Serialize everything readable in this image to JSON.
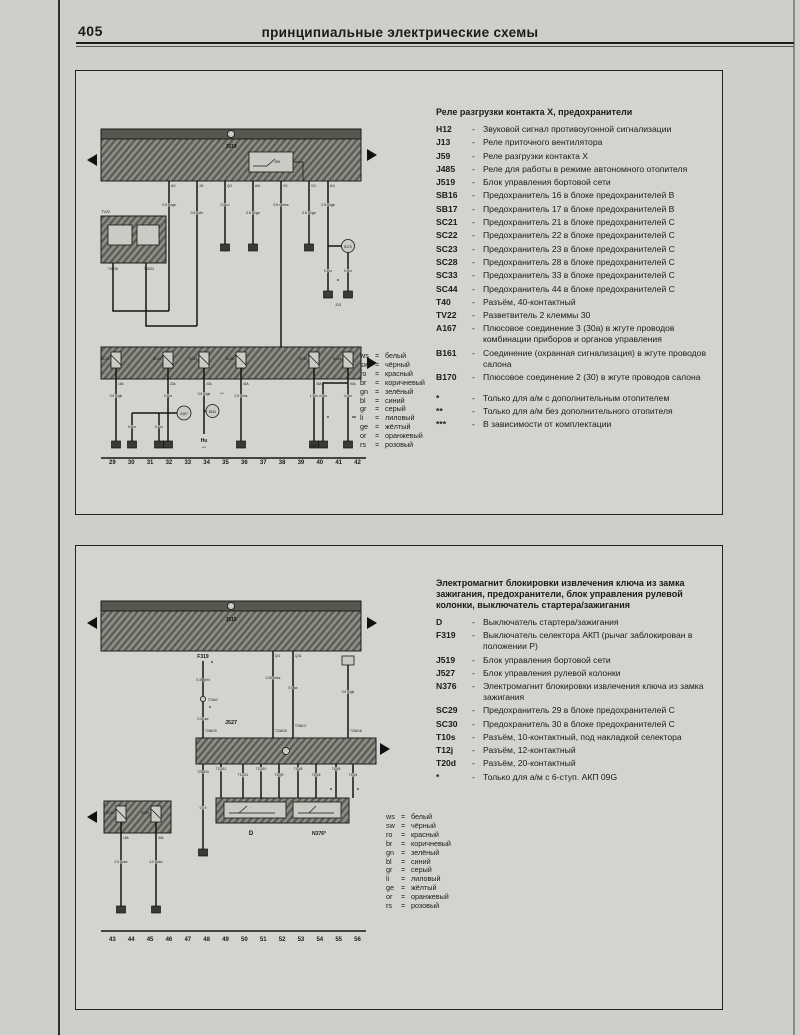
{
  "page": {
    "number": "405",
    "title": "принципиальные электрические схемы"
  },
  "wire_color_legend": [
    {
      "code": "ws",
      "name": "белый"
    },
    {
      "code": "sw",
      "name": "чёрный"
    },
    {
      "code": "ro",
      "name": "красный"
    },
    {
      "code": "br",
      "name": "коричневый"
    },
    {
      "code": "gn",
      "name": "зелёный"
    },
    {
      "code": "bl",
      "name": "синий"
    },
    {
      "code": "gr",
      "name": "серый"
    },
    {
      "code": "li",
      "name": "лиловый"
    },
    {
      "code": "ge",
      "name": "жёлтый"
    },
    {
      "code": "or",
      "name": "оранжевый"
    },
    {
      "code": "rs",
      "name": "розовый"
    }
  ],
  "d1": {
    "legend_title": "Реле разгрузки контакта X, предохранители",
    "legend": [
      {
        "term": "H12",
        "desc": "Звуковой сигнал противоугонной сигнализации"
      },
      {
        "term": "J13",
        "desc": "Реле приточного вентилятора"
      },
      {
        "term": "J59",
        "desc": "Реле разгрузки контакта X"
      },
      {
        "term": "J485",
        "desc": "Реле для работы в режиме автономного отопителя"
      },
      {
        "term": "J519",
        "desc": "Блок управления бортовой сети"
      },
      {
        "term": "SB16",
        "desc": "Предохранитель 16 в блоке предохранителей B"
      },
      {
        "term": "SB17",
        "desc": "Предохранитель 17 в блоке предохранителей B"
      },
      {
        "term": "SC21",
        "desc": "Предохранитель 21 в блоке предохранителей C"
      },
      {
        "term": "SC22",
        "desc": "Предохранитель 22 в блоке предохранителей C"
      },
      {
        "term": "SC23",
        "desc": "Предохранитель 23 в блоке предохранителей C"
      },
      {
        "term": "SC28",
        "desc": "Предохранитель 28 в блоке предохранителей C"
      },
      {
        "term": "SC33",
        "desc": "Предохранитель 33 в блоке предохранителей C"
      },
      {
        "term": "SC44",
        "desc": "Предохранитель 44 в блоке предохранителей C"
      },
      {
        "term": "T40",
        "desc": "Разъём, 40-контактный"
      },
      {
        "term": "TV22",
        "desc": "Разветвитель 2 клеммы 30"
      },
      {
        "term": "A167",
        "desc": "Плюсовое соединение 3 (30a) в жгуте проводов комбинации приборов и органов управления"
      },
      {
        "term": "B161",
        "desc": "Соединение (охранная сигнализация) в жгуте проводов салона"
      },
      {
        "term": "B170",
        "desc": "Плюсовое соединение 2 (30) в жгуте проводов салона"
      }
    ],
    "notes": [
      {
        "term": "*",
        "desc": "Только для а/м с дополнительным отопителем"
      },
      {
        "term": "**",
        "desc": "Только для а/м без дополнительного отопителя"
      },
      {
        "term": "***",
        "desc": "В зависимости от комплектации"
      }
    ],
    "tracks": [
      "29",
      "30",
      "31",
      "32",
      "33",
      "34",
      "35",
      "36",
      "37",
      "38",
      "39",
      "40",
      "41",
      "42"
    ],
    "s": {
      "unit": "J519",
      "relay": "J59",
      "splitter": "TV22",
      "splitter_pins": [
        "T40/18",
        "T40/23"
      ],
      "pins": [
        "A/1",
        "J/3",
        "Q/1",
        "A/6",
        "V/1",
        "V/2",
        "A/4"
      ],
      "wires": [
        "2.5 ro/ge",
        "0.5 ro/br",
        "2.5 ro",
        "0.5 ro/ge",
        "0.5 sw/ws",
        "0.5 ro/ge",
        "2.5 ro/ge"
      ],
      "b170": {
        "label": "B170",
        "w1": "0.5 ro",
        "w2": "0.5 ro",
        "mark": "*",
        "target": "J13"
      },
      "fuses": [
        {
          "n": "SC21",
          "a": "15A"
        },
        {
          "n": "SC22",
          "a": "23A"
        },
        {
          "n": "SC23",
          "a": "23A"
        },
        {
          "n": "SC28",
          "a": "44A"
        },
        {
          "n": "SC33",
          "a": "35A"
        },
        {
          "n": "SC44",
          "a": "50A"
        }
      ],
      "drops": {
        "c1": "0.5 ro/gn",
        "c2": "0.5 ro",
        "c3": "0.5 ro/ge",
        "c3m": "***",
        "c4": "2.5 ro/ws",
        "c5": "1.5 ro",
        "c6a": "4.0 ro",
        "c6am": "*",
        "c6b": "4.0 ro",
        "c6bm": "**"
      },
      "a167": {
        "label": "A167",
        "b1": "0.5 ro",
        "b2": "0.5 ro"
      },
      "b161": {
        "label": "B161",
        "term": "Hu",
        "mark": "***"
      },
      "j485": "J485"
    }
  },
  "d2": {
    "legend_title": "Электромагнит блокировки извлечения ключа из замка зажигания, предохранители, блок управления рулевой колонки, выключатель стартера/зажигания",
    "legend": [
      {
        "term": "D",
        "desc": "Выключатель стартера/зажигания"
      },
      {
        "term": "F319",
        "desc": "Выключатель селектора АКП (рычаг заблокирован в положении P)"
      },
      {
        "term": "J519",
        "desc": "Блок управления бортовой сети"
      },
      {
        "term": "J527",
        "desc": "Блок управления рулевой колонки"
      },
      {
        "term": "N376",
        "desc": "Электромагнит блокировки извлечения ключа из замка зажигания"
      },
      {
        "term": "SC29",
        "desc": "Предохранитель 29 в блоке предохранителей C"
      },
      {
        "term": "SC30",
        "desc": "Предохранитель 30 в блоке предохранителей C"
      },
      {
        "term": "T10s",
        "desc": "Разъём, 10-контактный, под накладкой селектора"
      },
      {
        "term": "T12j",
        "desc": "Разъём, 12-контактный"
      },
      {
        "term": "T20d",
        "desc": "Разъём, 20-контактный"
      },
      {
        "term": "*",
        "desc": "Только для а/м с 6-ступ. АКП 09G"
      }
    ],
    "tracks": [
      "43",
      "44",
      "45",
      "46",
      "47",
      "48",
      "49",
      "50",
      "51",
      "52",
      "53",
      "54",
      "55",
      "56"
    ],
    "s": {
      "unit": "J519",
      "unit2": "J527",
      "qpins": [
        "Q/1",
        "Q/11"
      ],
      "qwires": [
        "0.35 ro/ws",
        "0.5 sw"
      ],
      "f319": {
        "label": "F319",
        "m1": "*",
        "w1": "0.35 gr/bl",
        "conn": "T10s/2",
        "m2": "*",
        "w2": "0.35 sw"
      },
      "rwire": "0.5 ro/ge",
      "t20d": [
        "T20d/19",
        "T20d/16",
        "T20d/17",
        "T20d/18"
      ],
      "t12j": [
        "T12j/12",
        "T12j/11",
        "T12j/10",
        "T12j/9",
        "T12j/8",
        "T12j/6",
        "T12j/5",
        "T12j/4"
      ],
      "t12jm": "*",
      "leftdrop": {
        "pin": "T20d/20",
        "w": "0.5 li"
      },
      "dbox": {
        "d": "D",
        "n": "N376*"
      },
      "sc": {
        "f1": "SC29",
        "a1": "15A",
        "f2": "SC30",
        "a2": "30A",
        "w1": "2.5 ro/sw",
        "w2": "4.0 ro/sw"
      }
    }
  }
}
